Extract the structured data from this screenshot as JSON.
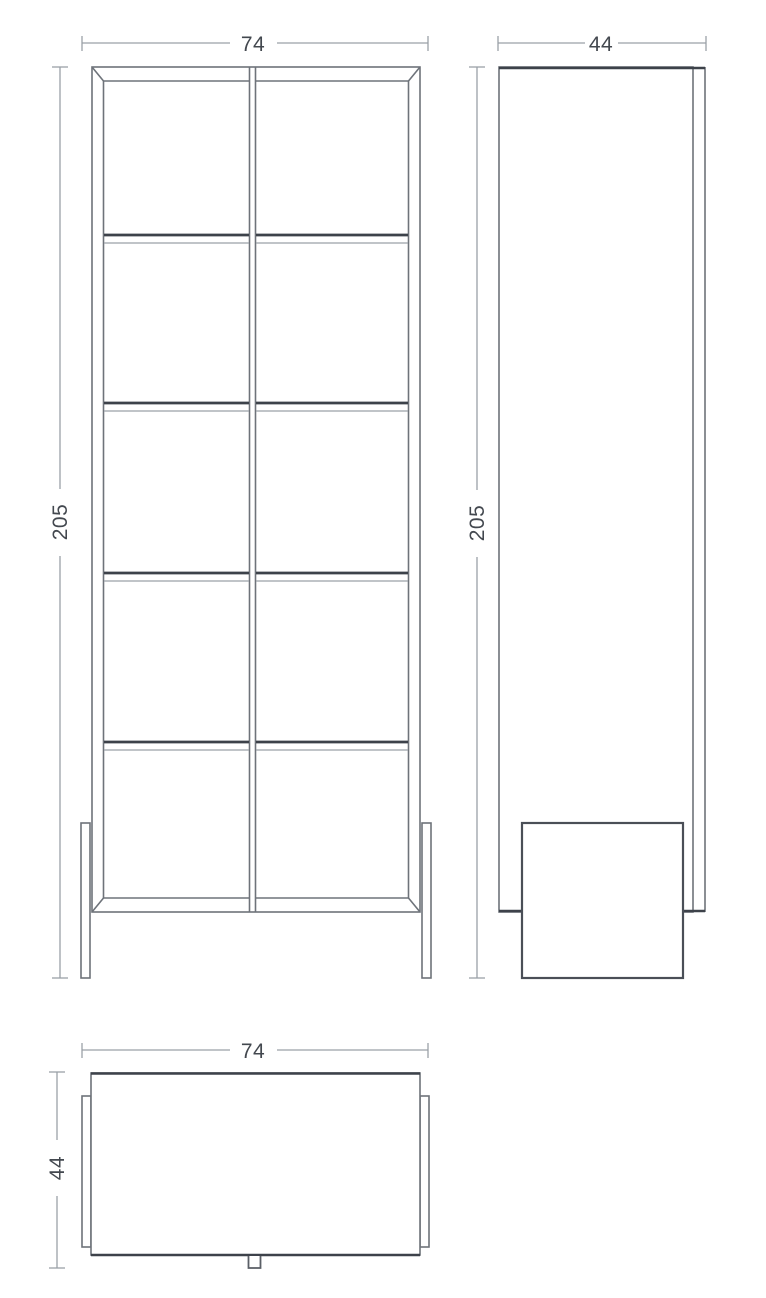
{
  "drawing": {
    "title": "Cabinet technical drawing — front, side and top views",
    "views": {
      "front": {
        "name": "front view",
        "width_label": "74",
        "height_label": "205"
      },
      "side": {
        "name": "side view",
        "depth_label": "44",
        "height_label": "205"
      },
      "top": {
        "name": "top view",
        "width_label": "74",
        "depth_label": "44"
      }
    },
    "colors": {
      "background": "#ffffff",
      "outline": "#6e737a",
      "heavy_line": "#3d424a",
      "dimension_line": "#9aa0a7",
      "dimension_text": "#43484f"
    }
  }
}
